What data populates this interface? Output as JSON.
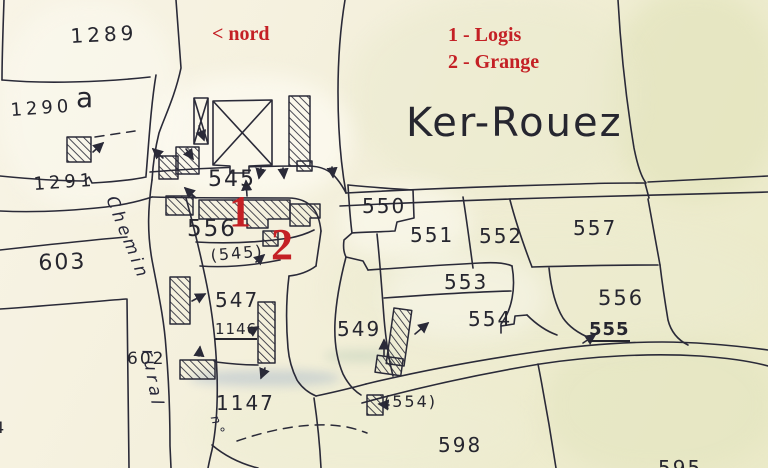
{
  "map": {
    "title": "Ker-Rouez",
    "north_indicator": "< nord",
    "legend": {
      "item1": "1 - Logis",
      "item2": "2 - Grange"
    },
    "markers": {
      "logis": "1",
      "grange": "2"
    },
    "road": {
      "part1": "Chemin",
      "part2": "rural",
      "part3": "n°"
    },
    "parcels": {
      "p1289": "1289",
      "p1290": "1290",
      "p1290a": "a",
      "p1291": "1291",
      "p603": "603",
      "p602": "602",
      "p545": "545",
      "p556w": "556",
      "p545b": "(545)",
      "p547": "547",
      "p1146": "1146",
      "p1147": "1147",
      "p550": "550",
      "p551": "551",
      "p552": "552",
      "p557": "557",
      "p553": "553",
      "p556e": "556",
      "p554": "554",
      "p555": "555",
      "p554b": "(554)",
      "p549": "549",
      "p598": "598",
      "p595": "595",
      "p4": "4"
    },
    "colors": {
      "ink": "#2a2a38",
      "red": "#c42025",
      "paper": "#f6f2e0"
    }
  }
}
